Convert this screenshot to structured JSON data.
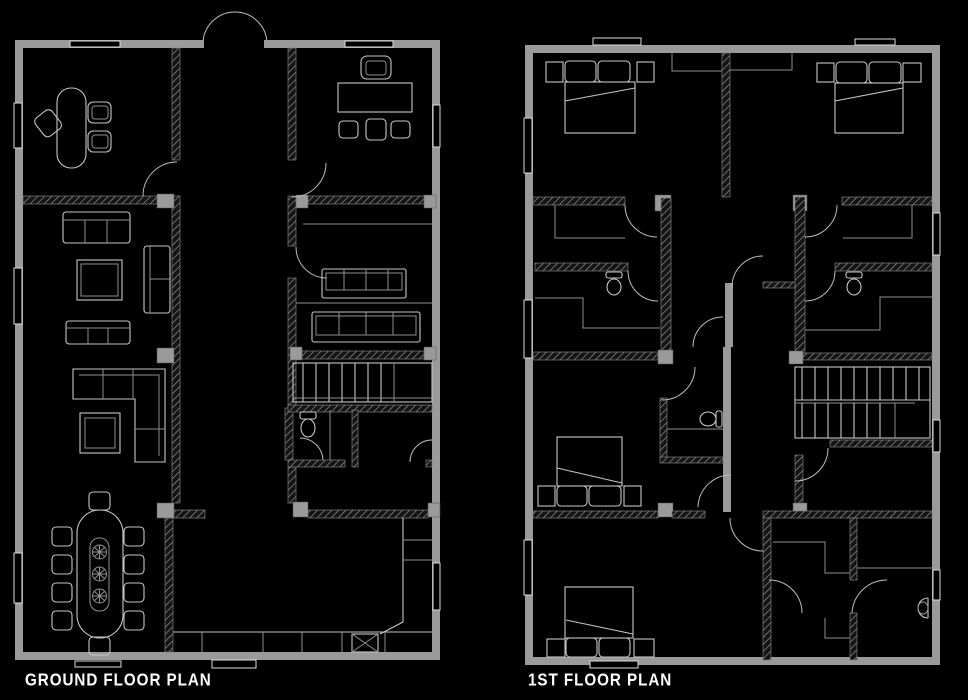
{
  "page": {
    "background": "#000000"
  },
  "colors": {
    "background": "#000000",
    "wall_gray": "#9a9a9a",
    "furniture_line": "#c6c6c6",
    "dim_line": "#8f8f8f",
    "label_text": "#ffffff"
  },
  "labels": {
    "ground_floor": "GROUND FLOOR PLAN",
    "first_floor": "1ST FLOOR PLAN"
  },
  "plans": {
    "ground_floor": {
      "title": "GROUND FLOOR PLAN",
      "furniture_icons": [
        "reception-desk",
        "swivel-chair",
        "guest-chairs",
        "meeting-table",
        "meeting-chairs",
        "three-seat-sofa",
        "coffee-table",
        "chaise-seat",
        "two-seat-sofa",
        "l-shaped-sofa",
        "side-table",
        "wall-bench",
        "staircase",
        "toilet",
        "dining-table-eight-chairs",
        "kitchen-counter",
        "appliance-box",
        "double-entry-door",
        "windows"
      ]
    },
    "first_floor": {
      "title": "1ST FLOOR PLAN",
      "furniture_icons": [
        "double-bed",
        "pillows",
        "nightstands",
        "wardrobe",
        "toilet",
        "staircase",
        "wash-basin",
        "doors",
        "windows"
      ]
    }
  }
}
